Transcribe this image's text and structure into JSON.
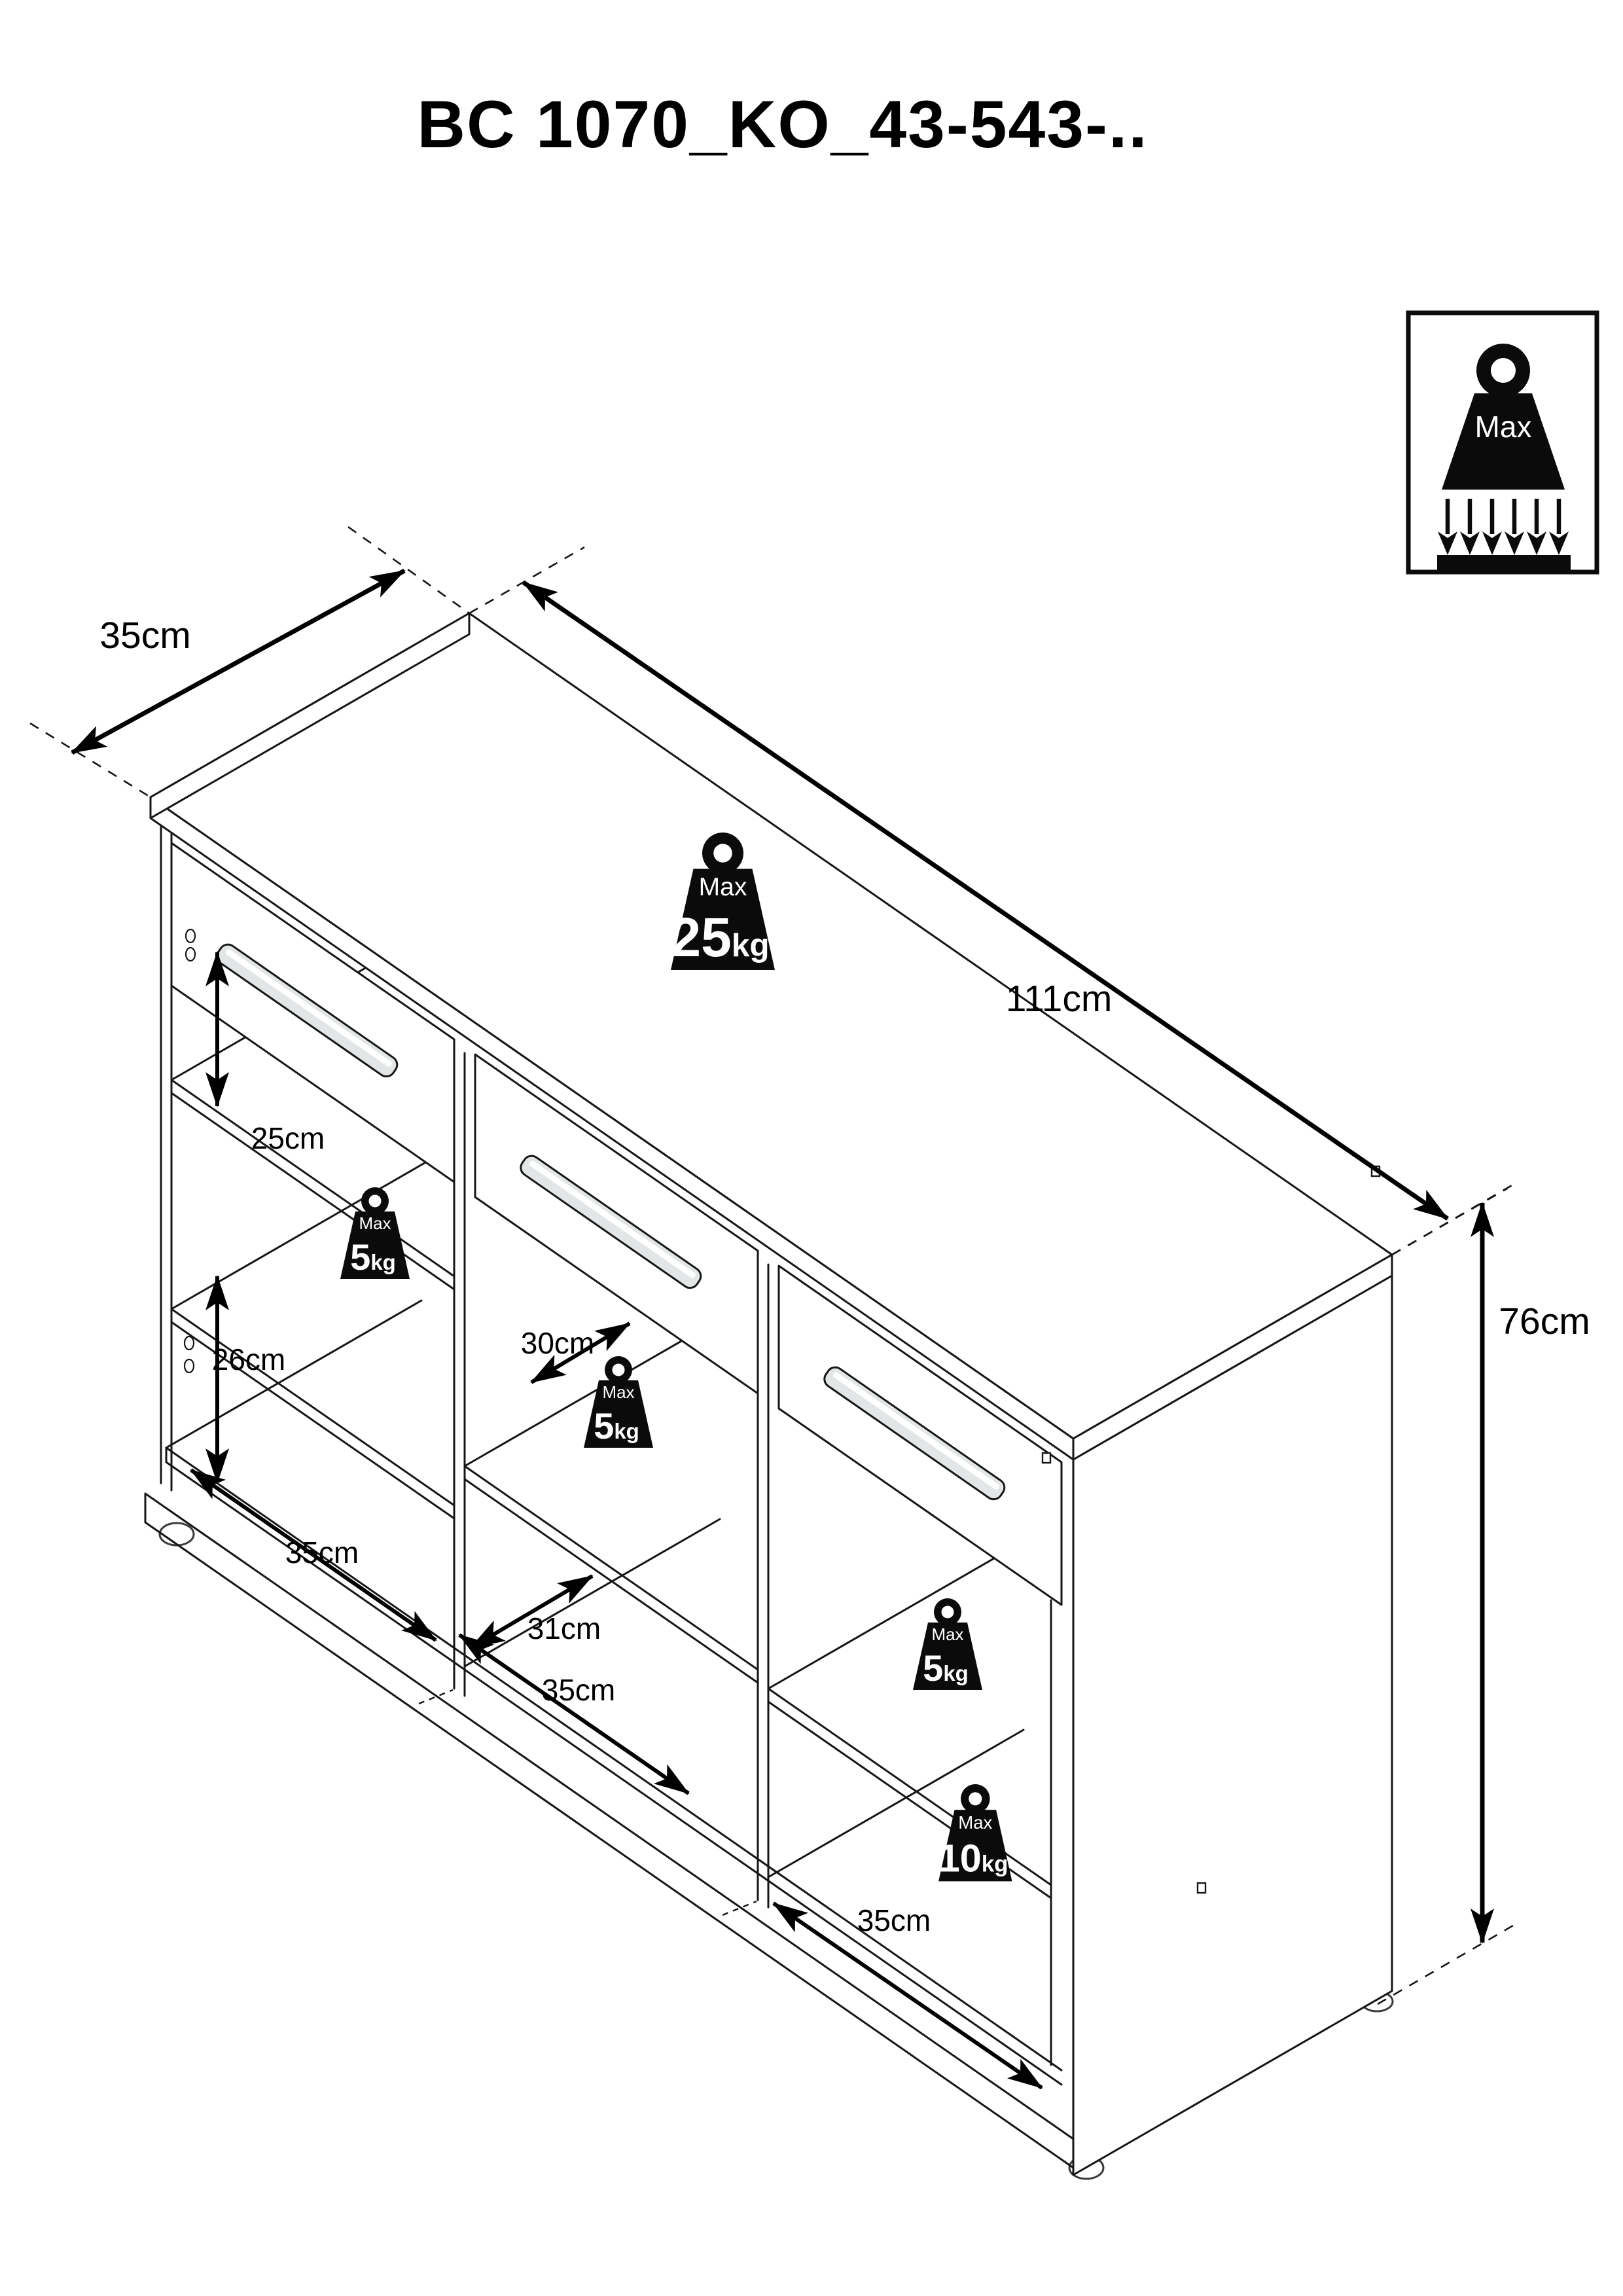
{
  "title": "BC 1070_KO_43-543-..",
  "max_load_badge": {
    "label": "Max"
  },
  "dimensions": {
    "top_depth": "35cm",
    "top_width": "111cm",
    "height": "76cm",
    "left_gap_upper": "25cm",
    "left_gap_lower": "26cm",
    "left_compartment_width": "35cm",
    "middle_shelf_depth": "30cm",
    "middle_bottom_depth": "31cm",
    "middle_compartment_width": "35cm",
    "right_compartment_width": "35cm"
  },
  "weight_limits": {
    "top": {
      "label": "Max",
      "value": "25",
      "unit": "kg"
    },
    "left_shelf": {
      "label": "Max",
      "value": "5",
      "unit": "kg"
    },
    "middle_shelf": {
      "label": "Max",
      "value": "5",
      "unit": "kg"
    },
    "right_shelf": {
      "label": "Max",
      "value": "5",
      "unit": "kg"
    },
    "right_bottom": {
      "label": "Max",
      "value": "10",
      "unit": "kg"
    }
  },
  "colors": {
    "line": "#161616",
    "background": "#ffffff",
    "handle": "#e3e6e7"
  }
}
